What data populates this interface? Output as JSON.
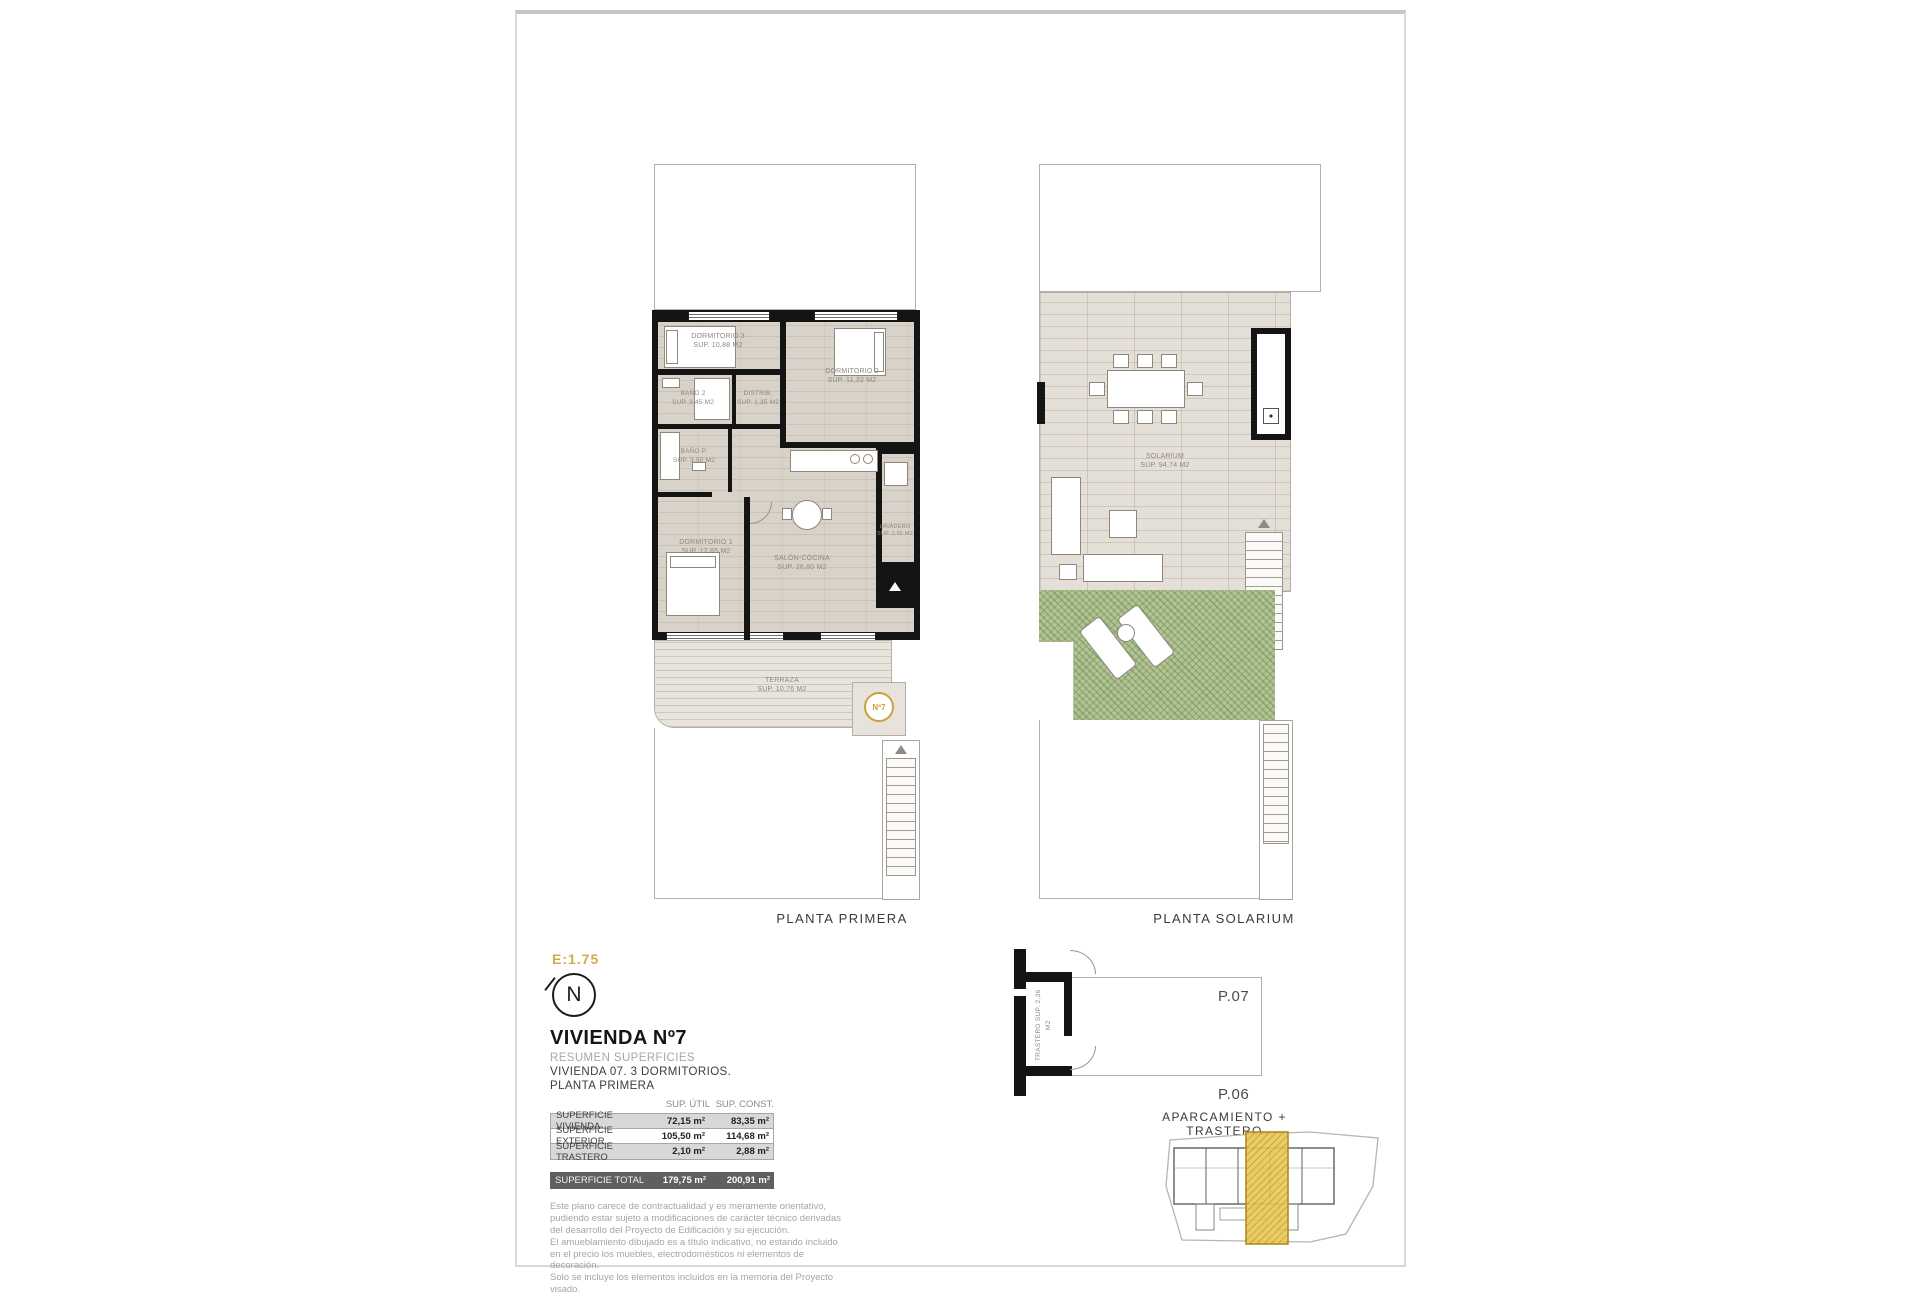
{
  "sheet": {
    "scale": "E:1.75",
    "north": "N"
  },
  "title_block": {
    "title": "VIVIENDA Nº7",
    "subtitle": "RESUMEN SUPERFICIES",
    "descriptor": "VIVIENDA 07. 3 DORMITORIOS.",
    "floor": "PLANTA PRIMERA"
  },
  "areas_table": {
    "headers": {
      "util": "SUP. ÚTIL",
      "const": "SUP. CONST."
    },
    "rows": [
      {
        "label": "SUPERFICIE VIVIENDA",
        "util": "72,15 m²",
        "const": "83,35 m²"
      },
      {
        "label": "SUPERFICIE EXTERIOR",
        "util": "105,50 m²",
        "const": "114,68 m²"
      },
      {
        "label": "SUPERFICIE TRASTERO",
        "util": "2,10 m²",
        "const": "2,88 m²"
      }
    ],
    "total": {
      "label": "SUPERFICIE TOTAL",
      "util": "179,75 m²",
      "const": "200,91 m²"
    }
  },
  "disclaimer": {
    "p1": "Este plano carece de contractualidad y es meramente orientativo, pudiendo estar sujeto a modificaciones de carácter técnico derivadas del desarrollo del Proyecto de Edificación y su ejecución.",
    "p2": "El amueblamiento dibujado es a título indicativo, no estando incluido en el precio los muebles, electrodomésticos ni elementos de decoración.",
    "p3": "Solo se incluye los elementos incluidos en la memoria del Proyecto visado."
  },
  "planta_primera": {
    "caption": "PLANTA PRIMERA",
    "unit_marker": "Nº7",
    "rooms": {
      "dormitorio3": {
        "name": "DORMITORIO 3",
        "area": "SUP. 10,88 M2"
      },
      "dormitorio2": {
        "name": "DORMITORIO 2",
        "area": "SUP. 11,32 M2"
      },
      "bano2": {
        "name": "BAÑO 2",
        "area": "SUP. 3,45 M2"
      },
      "distribuidor": {
        "name": "DISTRIB.",
        "area": "SUP. 1,35 M2"
      },
      "banop": {
        "name": "BAÑO P.",
        "area": "SUP. 3,50 M2"
      },
      "dormitorio1": {
        "name": "DORMITORIO 1",
        "area": "SUP. 12,85 M2"
      },
      "salon": {
        "name": "SALÓN-COCINA",
        "area": "SUP. 26,80 M2"
      },
      "lavadero": {
        "name": "LAVADERO",
        "area": "SUP. 2,65 M2"
      },
      "terraza": {
        "name": "TERRAZA",
        "area": "SUP. 10,76 M2"
      }
    }
  },
  "planta_solarium": {
    "caption": "PLANTA SOLARIUM",
    "rooms": {
      "solarium": {
        "name": "SOLARIUM",
        "area": "SUP. 94,74 M2"
      }
    }
  },
  "trastero_detail": {
    "caption": "APARCAMIENTO + TRASTERO",
    "room": {
      "name": "TRASTERO",
      "area": "SUP. 2,36 M2"
    },
    "p07": "P.07",
    "p06": "P.06"
  },
  "colors": {
    "accent_gold": "#d0ac4a",
    "marker_gold": "#c9a23c",
    "highlight_gold": "#eac854",
    "floor": "#d8d2c8",
    "tile": "#e4dfd7",
    "grass": "#b2c493",
    "wall": "#141414",
    "row_gray": "#d8d8d8",
    "total_gray": "#5f5f5f"
  }
}
